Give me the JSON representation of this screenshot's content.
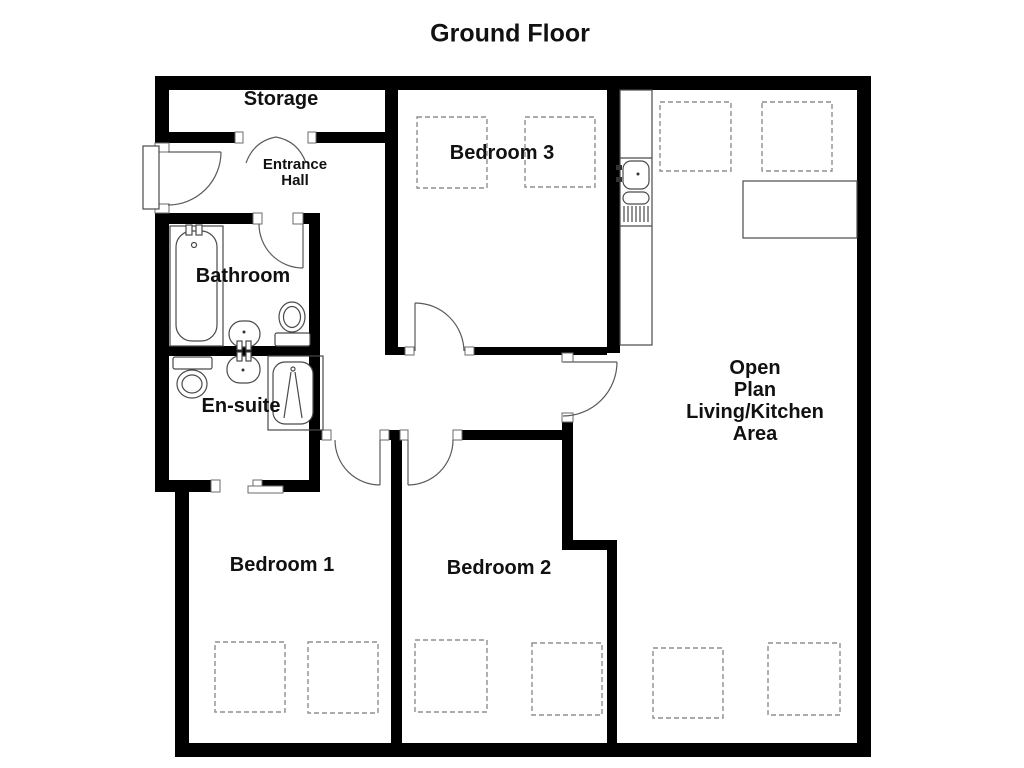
{
  "title": "Ground Floor",
  "colors": {
    "wall": "#000000",
    "fixture_line": "#4a4a4a",
    "dashed_furniture": "#8f8f8f",
    "background": "#ffffff",
    "text": "#111111"
  },
  "rooms": {
    "storage": {
      "label": "Storage"
    },
    "entrance_hall": {
      "label": "Entrance\nHall"
    },
    "bathroom": {
      "label": "Bathroom"
    },
    "ensuite": {
      "label": "En-suite"
    },
    "bedroom1": {
      "label": "Bedroom 1"
    },
    "bedroom2": {
      "label": "Bedroom 2"
    },
    "bedroom3": {
      "label": "Bedroom 3"
    },
    "open_plan": {
      "label": "Open\nPlan\nLiving/Kitchen\nArea"
    }
  },
  "fixtures": [
    "bathtub",
    "bathroom-basin",
    "bathroom-toilet",
    "ensuite-toilet",
    "ensuite-basin",
    "shower-enclosure",
    "kitchen-counter",
    "kitchen-sink",
    "kitchen-drainer",
    "dining-table",
    "entrance-door",
    "storage-double-door"
  ],
  "furniture_placeholders": {
    "bedroom1": 2,
    "bedroom2": 2,
    "bedroom3": 2,
    "open_plan": 4
  }
}
